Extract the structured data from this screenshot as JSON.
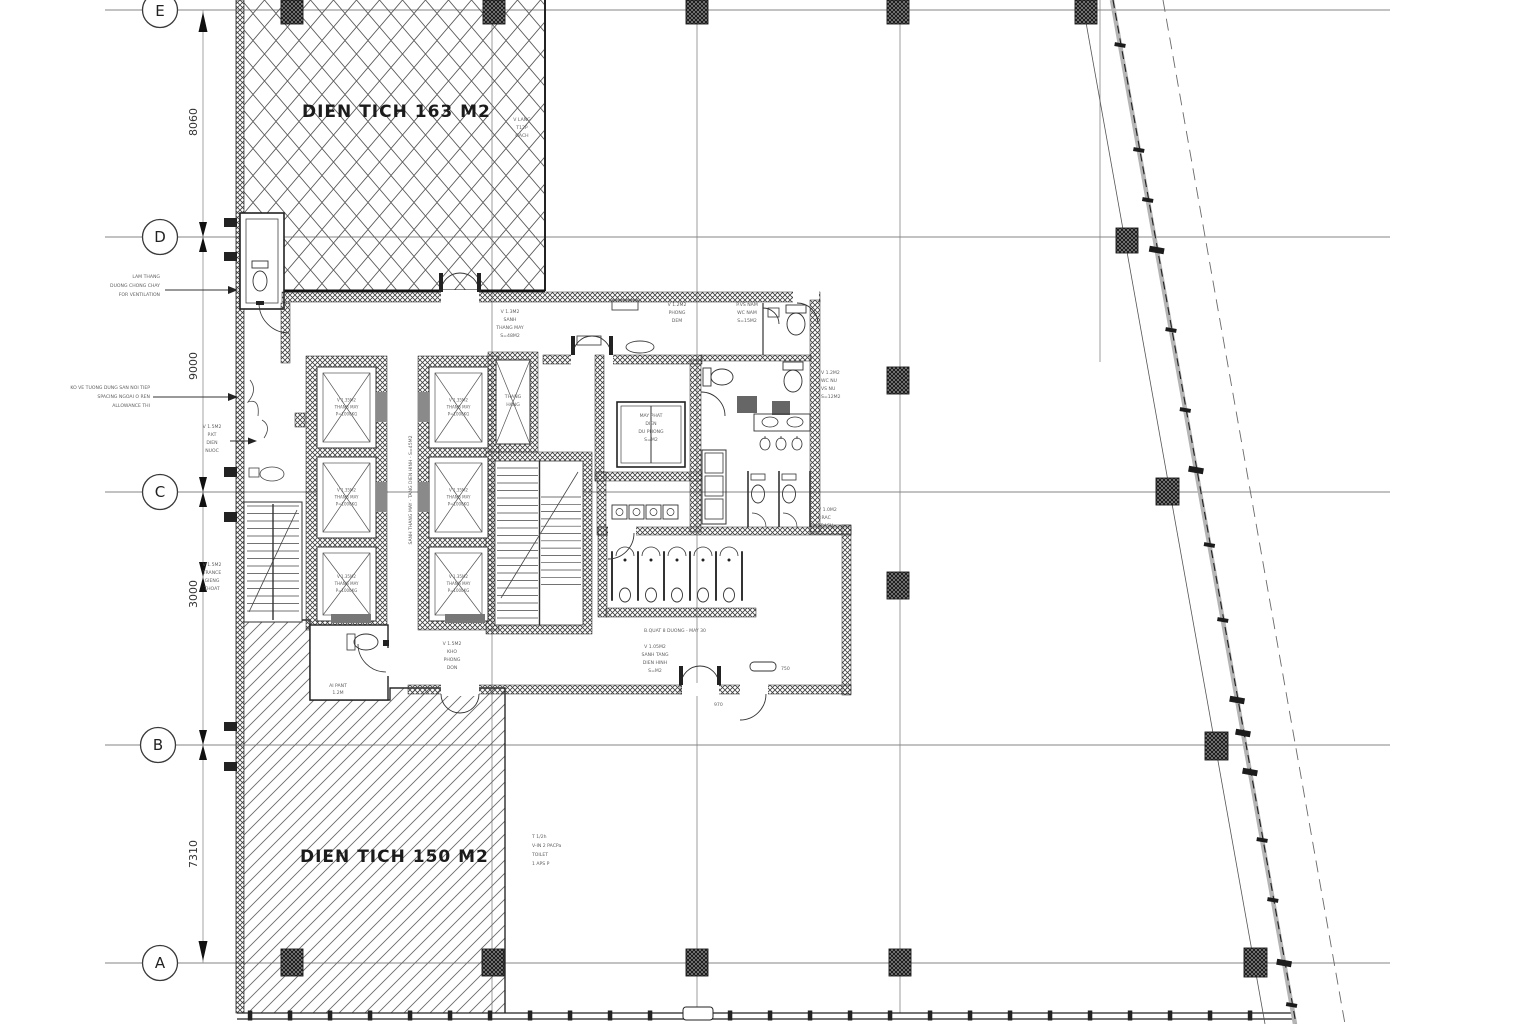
{
  "drawing": {
    "area_top_label": "DIEN TICH 163 M2",
    "area_bottom_label": "DIEN TICH 150 M2"
  },
  "grid_rows": [
    {
      "label": "E"
    },
    {
      "label": "D"
    },
    {
      "label": "C"
    },
    {
      "label": "B"
    },
    {
      "label": "A"
    }
  ],
  "dimensions": {
    "e_d": "8060",
    "d_c": "9000",
    "c_mid": "3000",
    "b_a": "7310"
  },
  "labels": {
    "cabin": [
      "V 1.35M2",
      "THANG MAY",
      "P=1000KG"
    ],
    "equip": [
      "MAY PHAT",
      "DIEN",
      "DU PHONG",
      "S=M2"
    ],
    "shaft": [
      "THANG",
      "HANG"
    ]
  },
  "annotations": {
    "a1": [
      "LAM THANG",
      "DUONG CHONG CHAY",
      "FOR VENTILATION"
    ],
    "a2": [
      "KO VE TUONG DUNG SAN NOI TIEP",
      "SPACING NGOAI O REN",
      "ALLOWANCE THI"
    ],
    "a3": [
      "V 1.5M2",
      "P.KT",
      "DIEN",
      "NUOC"
    ],
    "a4": [
      "V 1.5M2",
      "TRANCE",
      "GIENG",
      "THOAT"
    ],
    "a5": [
      "V LANG",
      "T12P",
      "GACH"
    ],
    "a6": [
      "V 1.3M2",
      "SANH",
      "THANG MAY",
      "S=48M2"
    ],
    "a7a": [
      "V 1.2M2",
      "PHONG",
      "DEM"
    ],
    "a7b": [
      "P.VS NAM",
      "WC NAM",
      "S=15M2"
    ],
    "a8": [
      "V 1.2M2",
      "WC NU",
      "VS NU",
      "S=12M2"
    ],
    "a9": [
      "V 1.0M2",
      "P.RAC",
      "TRASH"
    ],
    "a10": "SANH THANG MAY - TANG DIEN HINH - S=45M2",
    "a11a": "B.QUAT 8 DUONG - MAY 30",
    "a11b": [
      "V 1.05M2",
      "SANH TANG",
      "DIEN HINH",
      "S=M2"
    ],
    "a12": [
      "V 1.5M2",
      "KHO",
      "PHONG",
      "DON"
    ],
    "a13": [
      "AI PANT",
      "1.2M"
    ],
    "a14": [
      "T 1/2h",
      "V-IN 2 PACPa",
      "TOILET",
      "1 APS P"
    ],
    "b1": "970",
    "b2": "750"
  },
  "colors": {
    "background": "#ffffff",
    "line": "#2b2b2b",
    "grid_line": "#858585",
    "hatch": "#5a5a5a",
    "wall_fill": "#4a4a4a",
    "boundary_gray": "#b5b5b5",
    "text_primary": "#171717",
    "text_note": "#5f5f5f"
  }
}
